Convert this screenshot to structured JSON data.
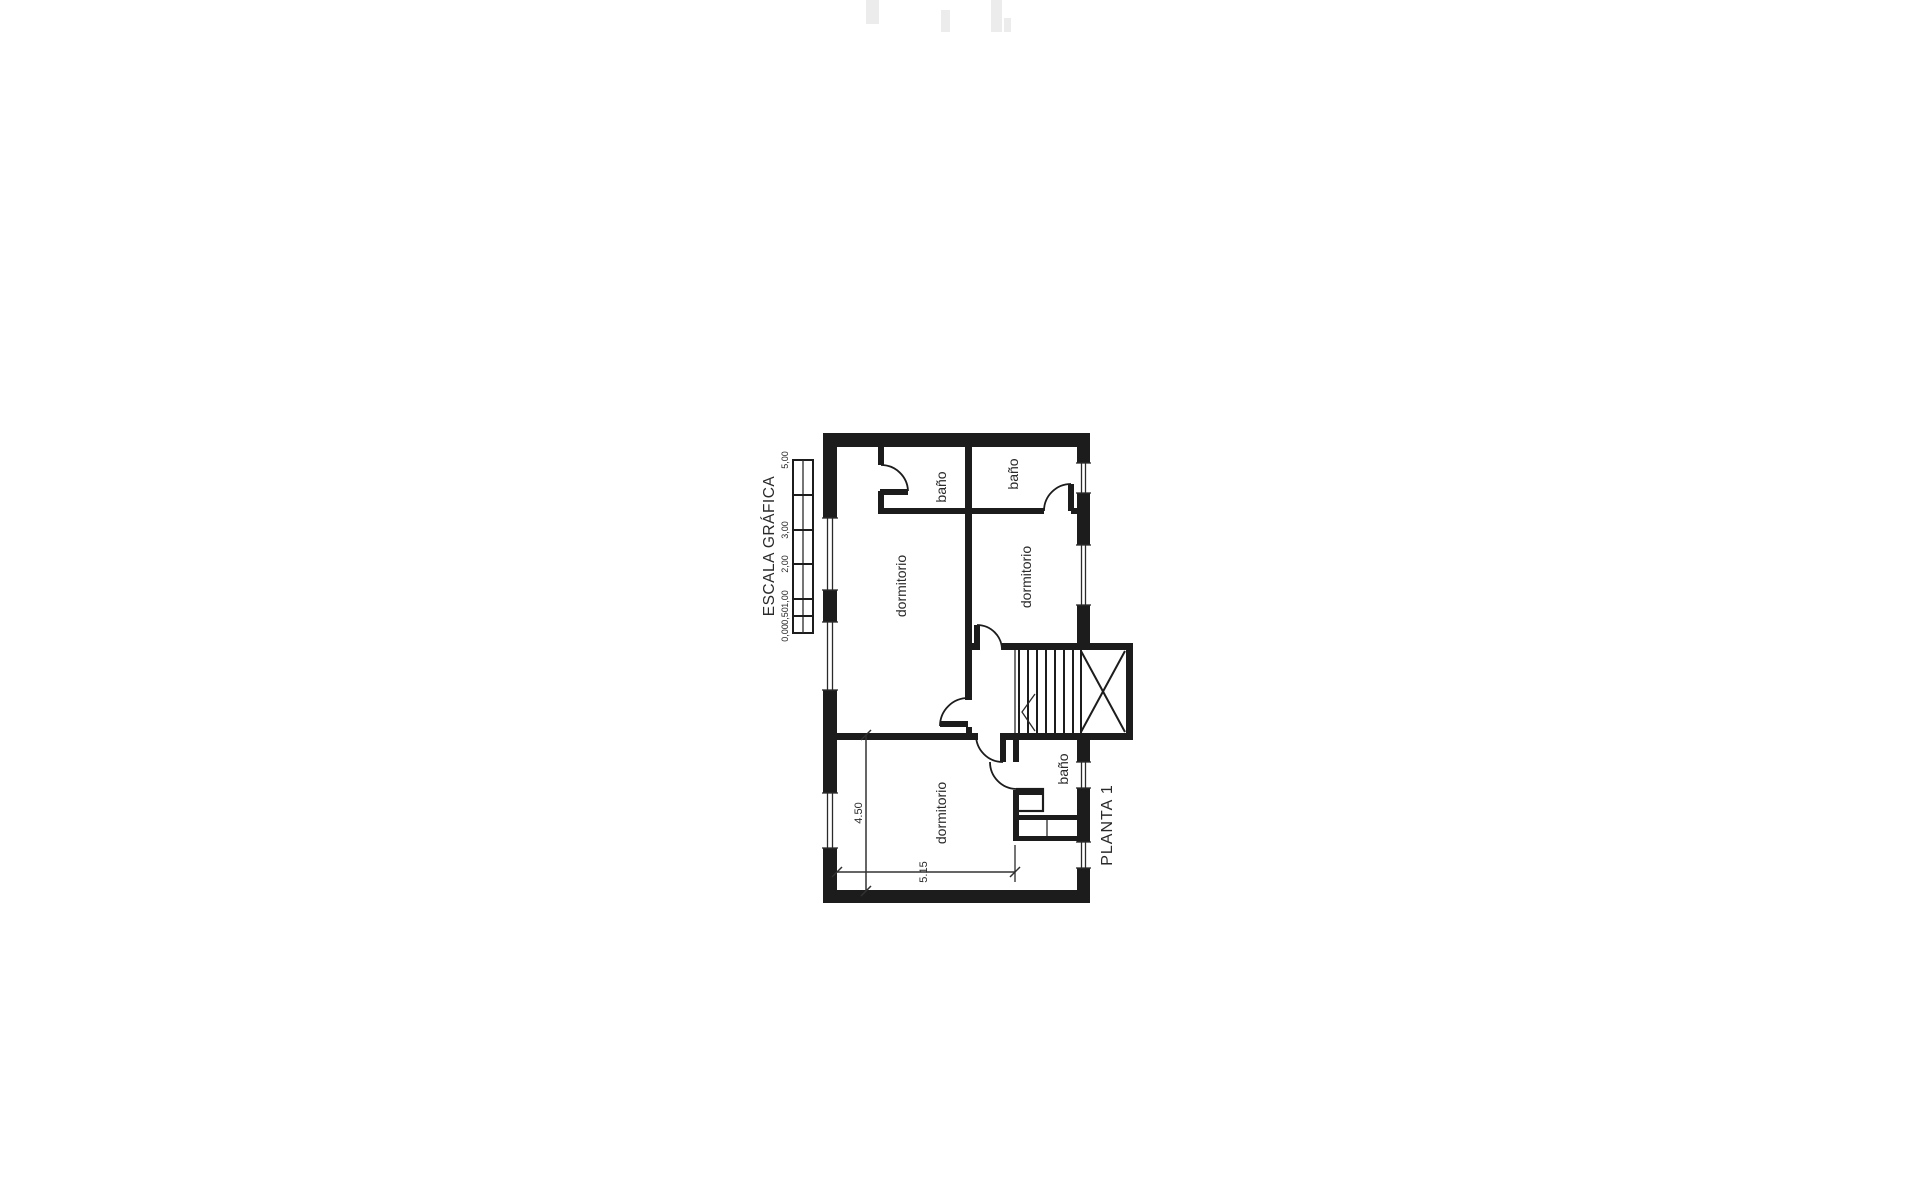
{
  "document": {
    "background": "#ffffff",
    "ink": "#1e1e1e"
  },
  "plan": {
    "title": "PLANTA 1",
    "rooms": [
      {
        "id": "bath-1",
        "label": "baño"
      },
      {
        "id": "bath-2",
        "label": "baño"
      },
      {
        "id": "bedroom-1",
        "label": "dormitorio"
      },
      {
        "id": "bedroom-2",
        "label": "dormitorio"
      },
      {
        "id": "bath-3",
        "label": "baño"
      },
      {
        "id": "bedroom-3",
        "label": "dormitorio"
      }
    ],
    "dimensions": [
      {
        "id": "bedroom-3-depth",
        "label": "4.50"
      },
      {
        "id": "bedroom-3-width",
        "label": "5.15"
      }
    ]
  },
  "scale_bar": {
    "title": "ESCALA GRÁFICA",
    "tick_labels": [
      "0,00",
      "0,50",
      "1,00",
      "2,00",
      "3,00",
      "5,00"
    ]
  }
}
